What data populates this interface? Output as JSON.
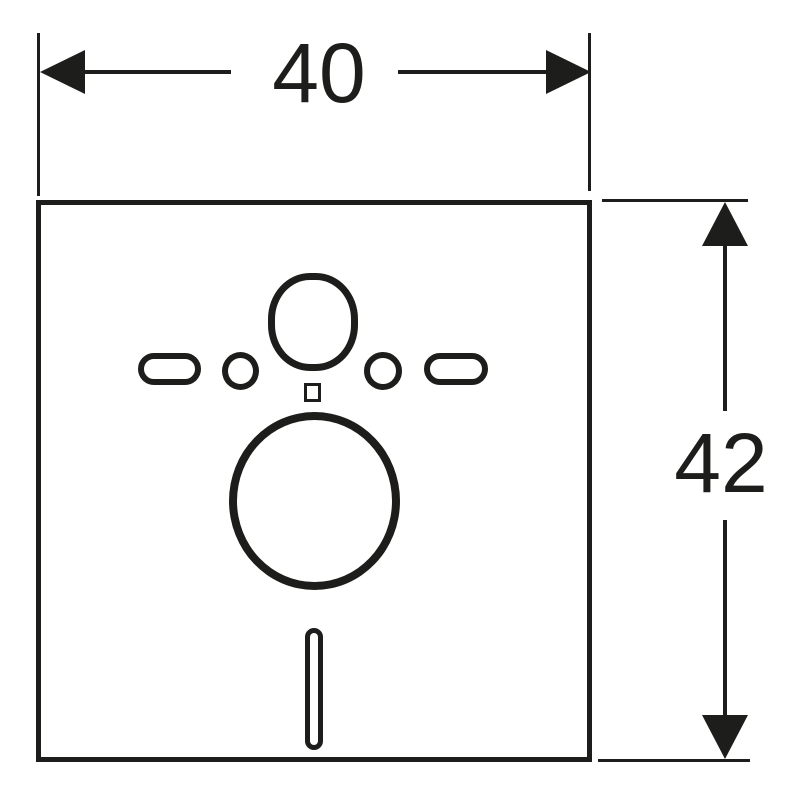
{
  "diagram": {
    "type": "technical-dimension-drawing",
    "colors": {
      "ink": "#1d1d1b",
      "background": "#ffffff"
    },
    "dimensions": {
      "width_label": "40",
      "height_label": "42"
    },
    "cutouts": [
      {
        "name": "top-round-hole"
      },
      {
        "name": "left-slot"
      },
      {
        "name": "left-round-hole"
      },
      {
        "name": "right-round-hole"
      },
      {
        "name": "right-slot"
      },
      {
        "name": "small-square-hole"
      },
      {
        "name": "large-round-hole"
      },
      {
        "name": "bottom-vertical-slot"
      }
    ]
  }
}
